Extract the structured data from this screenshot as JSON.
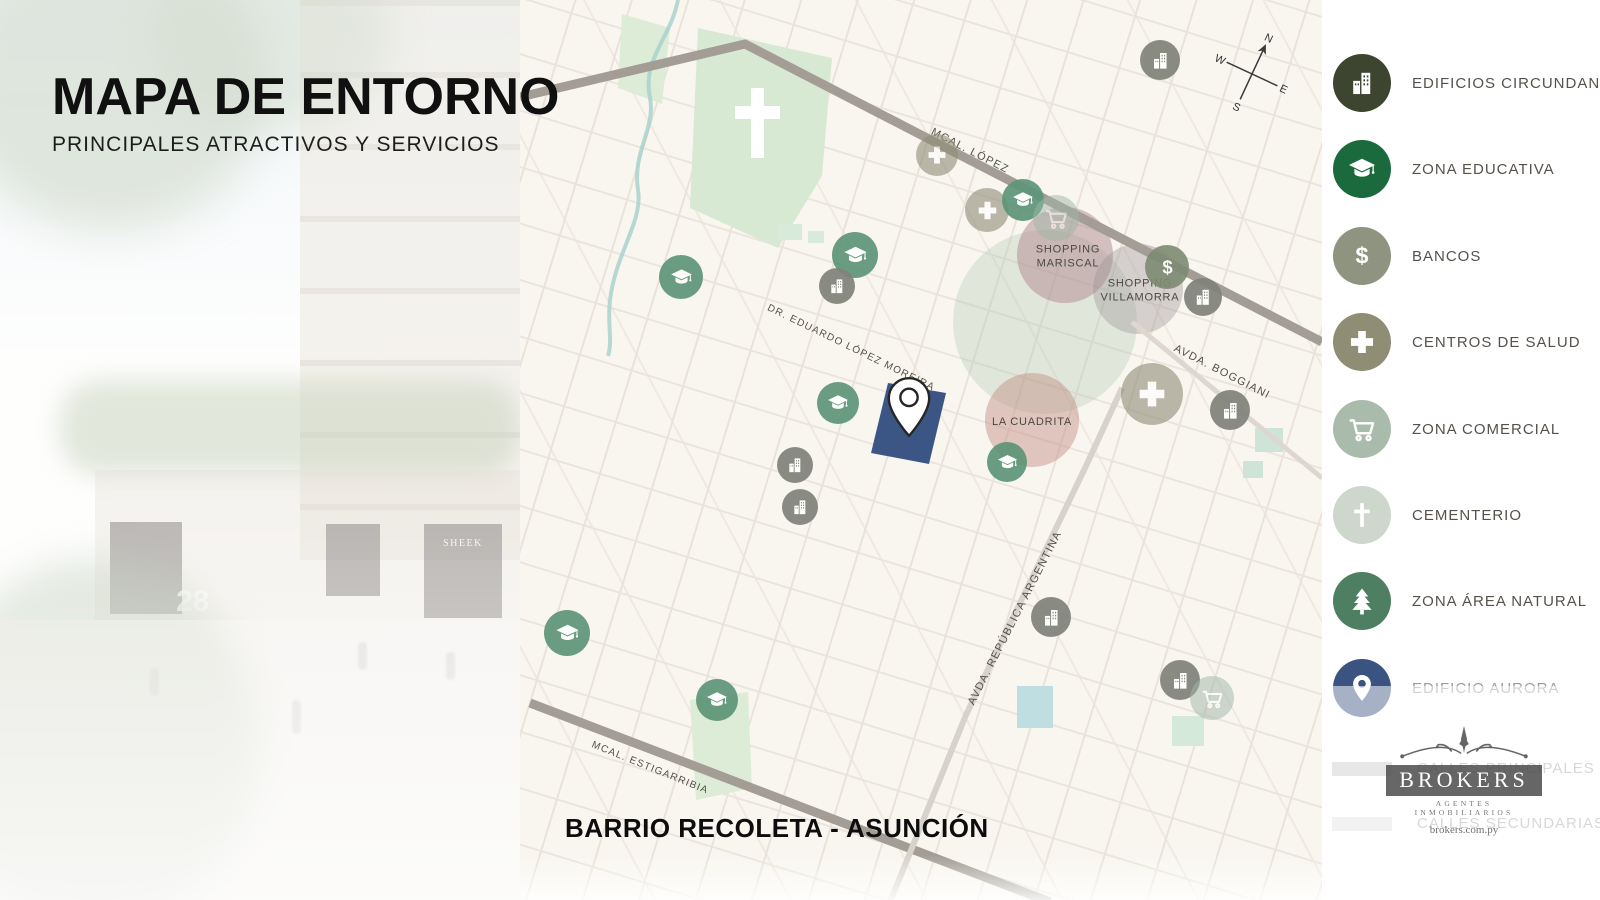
{
  "slide": {
    "title": "MAPA DE ENTORNO",
    "subtitle": "PRINCIPALES ATRACTIVOS Y SERVICIOS",
    "map_caption": "BARRIO RECOLETA - ASUNCIÓN"
  },
  "photo": {
    "signs": [
      "SHEEK",
      "28"
    ]
  },
  "map": {
    "street_labels": {
      "mcal_lopez": "MCAL. LÓPEZ",
      "eduardo_lopez_moreira": "DR. EDUARDO LÓPEZ MOREIRA",
      "avda_boggiani": "AVDA. BOGGIANI",
      "avda_republica_argentina": "AVDA. REPÚBLICA ARGENTINA",
      "mcal_estigarribia": "MCAL. ESTIGARRIBIA"
    },
    "area_labels": {
      "shopping_mariscal": "SHOPPING MARISCAL",
      "shopping_villamorra": "SHOPPING VILLAMORRA",
      "la_cuadrita": "LA CUADRITA"
    },
    "compass": {
      "n": "N",
      "e": "E",
      "w": "W",
      "s": "S"
    },
    "marker_styles": {
      "cap": {
        "color": "#5d9577",
        "icon": "graduation-cap-icon",
        "opacity": 0.92
      },
      "building": {
        "color": "#80837a",
        "icon": "buildings-icon",
        "opacity": 0.92
      },
      "dollar": {
        "color": "#7d8b72",
        "icon": "dollar-icon",
        "opacity": 0.9
      },
      "health": {
        "color": "#8f8d77",
        "icon": "health-cross-icon",
        "opacity": 0.6
      },
      "cart": {
        "color": "#9fb6a4",
        "icon": "cart-icon",
        "opacity": 0.5
      }
    },
    "markers": [
      {
        "type": "building",
        "x": 1160,
        "y": 60,
        "d": 40
      },
      {
        "type": "health",
        "x": 937,
        "y": 155,
        "d": 42
      },
      {
        "type": "health",
        "x": 987,
        "y": 210,
        "d": 44
      },
      {
        "type": "cap",
        "x": 1023,
        "y": 200,
        "d": 42
      },
      {
        "type": "cart",
        "x": 1056,
        "y": 218,
        "d": 46
      },
      {
        "type": "dollar",
        "x": 1167,
        "y": 267,
        "d": 44
      },
      {
        "type": "building",
        "x": 1203,
        "y": 297,
        "d": 38
      },
      {
        "type": "cap",
        "x": 855,
        "y": 255,
        "d": 46
      },
      {
        "type": "building",
        "x": 837,
        "y": 286,
        "d": 36
      },
      {
        "type": "cap",
        "x": 681,
        "y": 277,
        "d": 44
      },
      {
        "type": "health",
        "x": 1152,
        "y": 394,
        "d": 62
      },
      {
        "type": "building",
        "x": 1230,
        "y": 410,
        "d": 40
      },
      {
        "type": "cap",
        "x": 838,
        "y": 403,
        "d": 42
      },
      {
        "type": "building",
        "x": 795,
        "y": 465,
        "d": 36
      },
      {
        "type": "cap",
        "x": 1007,
        "y": 462,
        "d": 40
      },
      {
        "type": "building",
        "x": 800,
        "y": 507,
        "d": 36
      },
      {
        "type": "building",
        "x": 1051,
        "y": 617,
        "d": 40
      },
      {
        "type": "cap",
        "x": 567,
        "y": 633,
        "d": 46
      },
      {
        "type": "cap",
        "x": 717,
        "y": 700,
        "d": 42
      },
      {
        "type": "building",
        "x": 1180,
        "y": 680,
        "d": 40
      },
      {
        "type": "cart",
        "x": 1212,
        "y": 698,
        "d": 44
      }
    ]
  },
  "legend": {
    "items": [
      {
        "id": "edificios-circundantes",
        "icon": "buildings-icon",
        "color": "#3d4531",
        "label": "EDIFICIOS CIRCUNDANTES"
      },
      {
        "id": "zona-educativa",
        "icon": "graduation-cap-icon",
        "color": "#1b6a3e",
        "label": "ZONA EDUCATIVA"
      },
      {
        "id": "bancos",
        "icon": "dollar-icon",
        "color": "#8e9480",
        "label": "BANCOS"
      },
      {
        "id": "centros-de-salud",
        "icon": "health-cross-icon",
        "color": "#908d75",
        "label": "CENTROS DE SALUD"
      },
      {
        "id": "zona-comercial",
        "icon": "cart-icon",
        "color": "#a9bcab",
        "label": "ZONA COMERCIAL"
      },
      {
        "id": "cementerio",
        "icon": "latin-cross-icon",
        "color": "#cdd7cc",
        "label": "CEMENTERIO"
      },
      {
        "id": "zona-area-natural",
        "icon": "tree-icon",
        "color": "#4e7f62",
        "label": "ZONA ÁREA NATURAL"
      },
      {
        "id": "edificio-aurora",
        "icon": "pin-icon",
        "color": "#3a5380",
        "label": "EDIFICIO AURORA",
        "muted": true
      }
    ],
    "road_items": [
      {
        "id": "calles-principales",
        "label": "CALLES PRINCIPALES",
        "color": "#c9c9c9"
      },
      {
        "id": "calles-secundarias",
        "label": "CALLES SECUNDARIAS",
        "color": "#e2e2e2"
      }
    ]
  },
  "brand": {
    "name": "BROKERS",
    "tagline": "AGENTES INMOBILIARIOS",
    "website": "brokers.com.py"
  }
}
